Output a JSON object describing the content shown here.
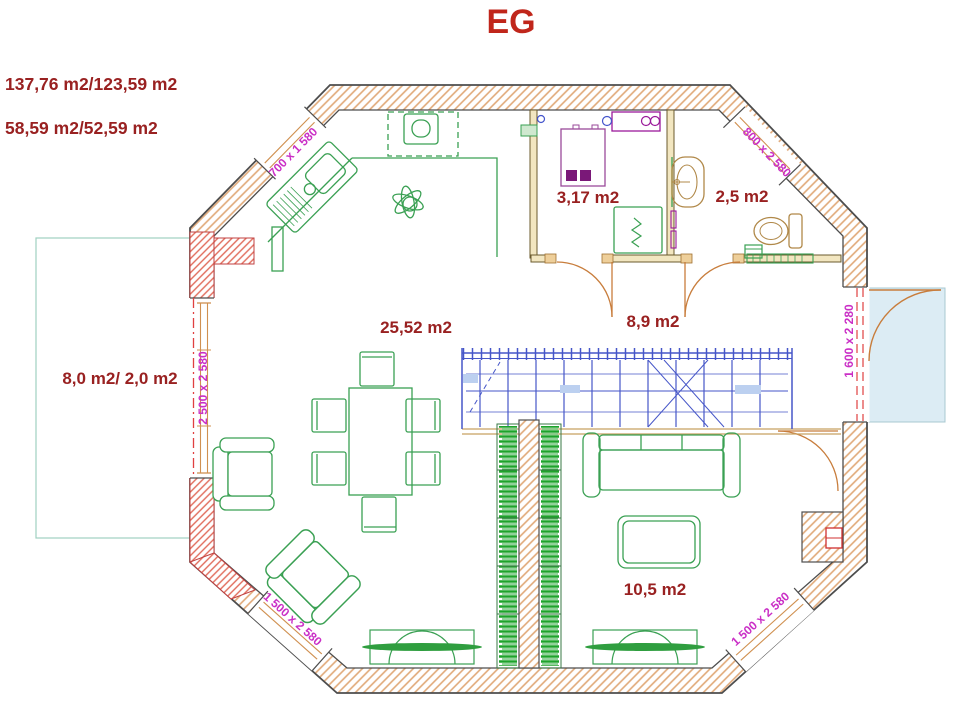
{
  "page_title": "EG",
  "summary": {
    "line1": "137,76 m2/123,59 m2",
    "line2": "58,59 m2/52,59 m2"
  },
  "rooms": {
    "utility": {
      "label": "3,17 m2"
    },
    "wc": {
      "label": "2,5 m2"
    },
    "hall": {
      "label": "8,9 m2"
    },
    "living_dining": {
      "label": "25,52 m2"
    },
    "terrace_left": {
      "label": "8,0 m2/ 2,0 m2"
    },
    "sitting_area": {
      "label": "10,5 m2"
    }
  },
  "openings": {
    "window_top_left": {
      "label": "700 x 1 580"
    },
    "door_top_right": {
      "label": "800 x 2 580"
    },
    "terrace_door_left": {
      "label": "2 500 x 2 580"
    },
    "door_right": {
      "label": "1 600 x 2 280"
    },
    "window_bottom_left": {
      "label": "1 500 x 2 580"
    },
    "window_bottom_right": {
      "label": "1 500 x 2 580"
    }
  },
  "colors": {
    "title_red": "#c0261b",
    "label_red": "#992121",
    "dimension_magenta": "#ca2fc6",
    "wall_outline": "#4d4d4d",
    "wall_hatch_tan": "#e0a877",
    "wall_hatch_red": "#e06a5a",
    "furniture_green": "#3aa053",
    "books_green": "#1da32a",
    "stair_blue": "#4656c8",
    "fixture_tan": "#b08848",
    "door_arc_tan": "#c87d3c",
    "terrace_fill_blue": "#dcecf4"
  }
}
